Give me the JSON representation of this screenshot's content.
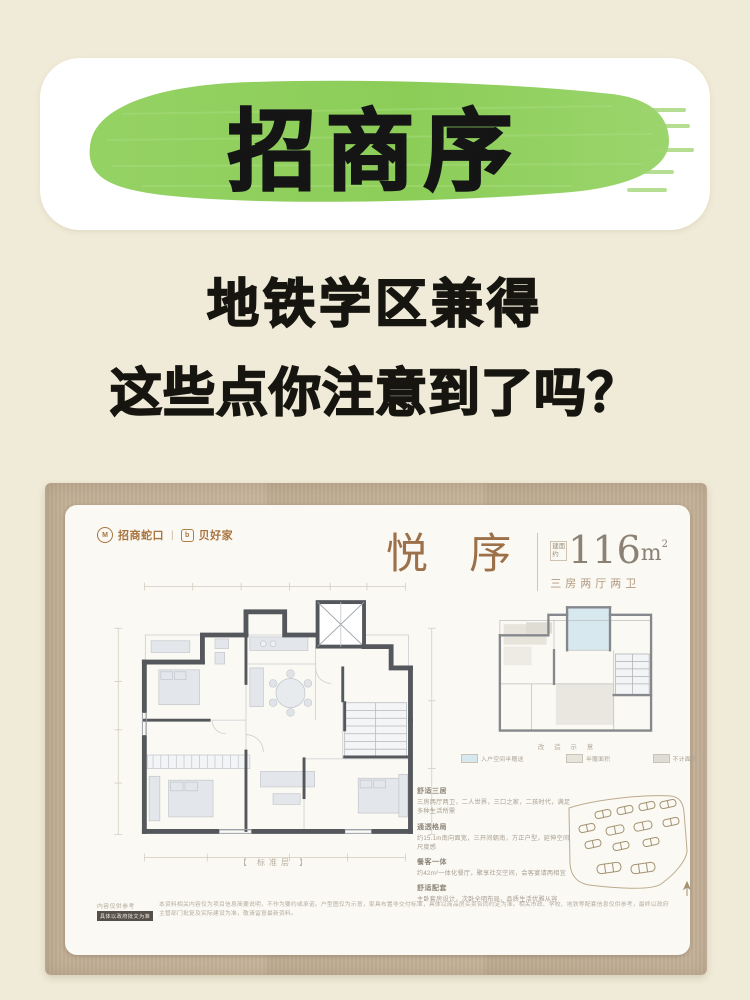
{
  "banner": {
    "title": "招商序"
  },
  "subtitle": {
    "line1": "地铁学区兼得",
    "line2": "这些点你注意到了吗？"
  },
  "card": {
    "brand": {
      "mark1": "M",
      "left": "招商蛇口",
      "sep": "|",
      "mark2": "b",
      "right": "贝好家"
    },
    "title": "悦 序",
    "area": {
      "prefix": "建面约",
      "value": "116",
      "unit": "m",
      "sup": "2"
    },
    "type_label": "三房两厅两卫",
    "floor_label": "【 标准层 】",
    "mini": {
      "caption": "改 造 示 意",
      "legend": [
        {
          "label": "入户空间半赠送",
          "color": "#d7e9ee"
        },
        {
          "label": "半赠面积",
          "color": "#e7e4db"
        },
        {
          "label": "不计面积",
          "color": "#dedcd3"
        }
      ]
    },
    "features": [
      {
        "title": "舒适三居",
        "body": "三房两厅两卫，二人世界，三口之家，二孩时代，满足多种生活所需"
      },
      {
        "title": "通透格局",
        "body": "约15.1m南向面宽，三开间朝南，方正户型，延伸空间尺度感"
      },
      {
        "title": "餐客一体",
        "body": "约42m²一体化餐厅，聚享社交空间，会客宴请两相宜"
      },
      {
        "title": "舒适配套",
        "body": "主卧套房设计，次卧全明布局，品质生活优雅从容"
      }
    ],
    "disclaimer": {
      "tag_line1": "内容仅供参考",
      "tag_line2": "具体以政府批文为准",
      "text": "本资料相关内容仅为项目信息简要说明，不作为要约或承诺。户型图仅为示意，家具布置非交付标准，具体以商品房买卖合同约定为准。相关市政、学校、地铁等配套信息仅供参考，最终以政府主管部门批复及实际建设为准，敬请留意最新资料。"
    }
  },
  "colors": {
    "page_background": "#f0ebd8",
    "brush_green": "#8fd05f",
    "frame_tan": "#c2b098",
    "accent_brown": "#9c7049",
    "area_gray": "#8b8174",
    "highlight_blue": "#d7e9ee",
    "wall_gray": "#54575b"
  }
}
